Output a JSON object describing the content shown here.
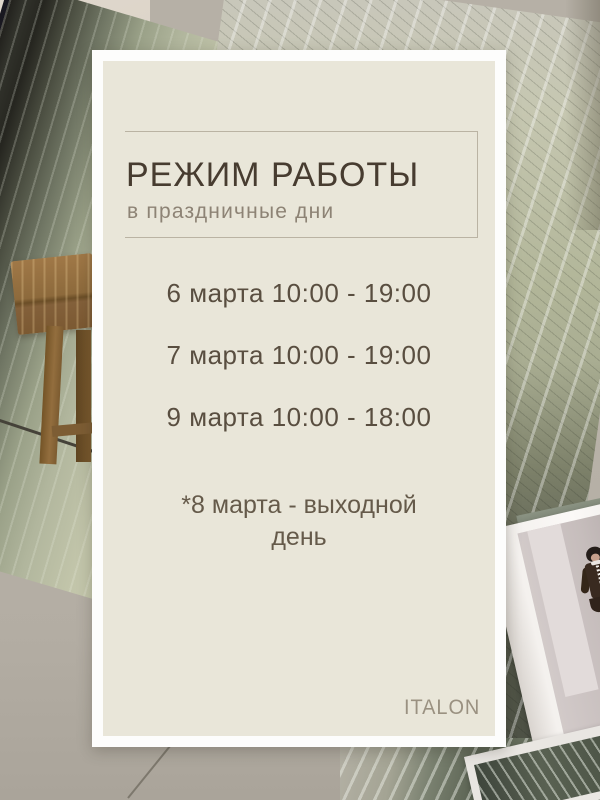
{
  "poster": {
    "title": "РЕЖИМ РАБОТЫ",
    "subtitle": "в праздничные дни",
    "schedule": [
      "6 марта 10:00 - 19:00",
      "7 марта 10:00 - 19:00",
      "9 марта 10:00 - 18:00"
    ],
    "note": "*8 марта - выходной день",
    "brand": "ITALON"
  },
  "colors": {
    "card_background": "#e9e6d9",
    "card_frame": "#fdfdfc",
    "title_text": "#473c30",
    "subtitle_text": "#8d8375",
    "schedule_text": "#594e40",
    "note_text": "#655a4a",
    "brand_text": "#9a9181",
    "divider_line": "#bab3a3"
  }
}
